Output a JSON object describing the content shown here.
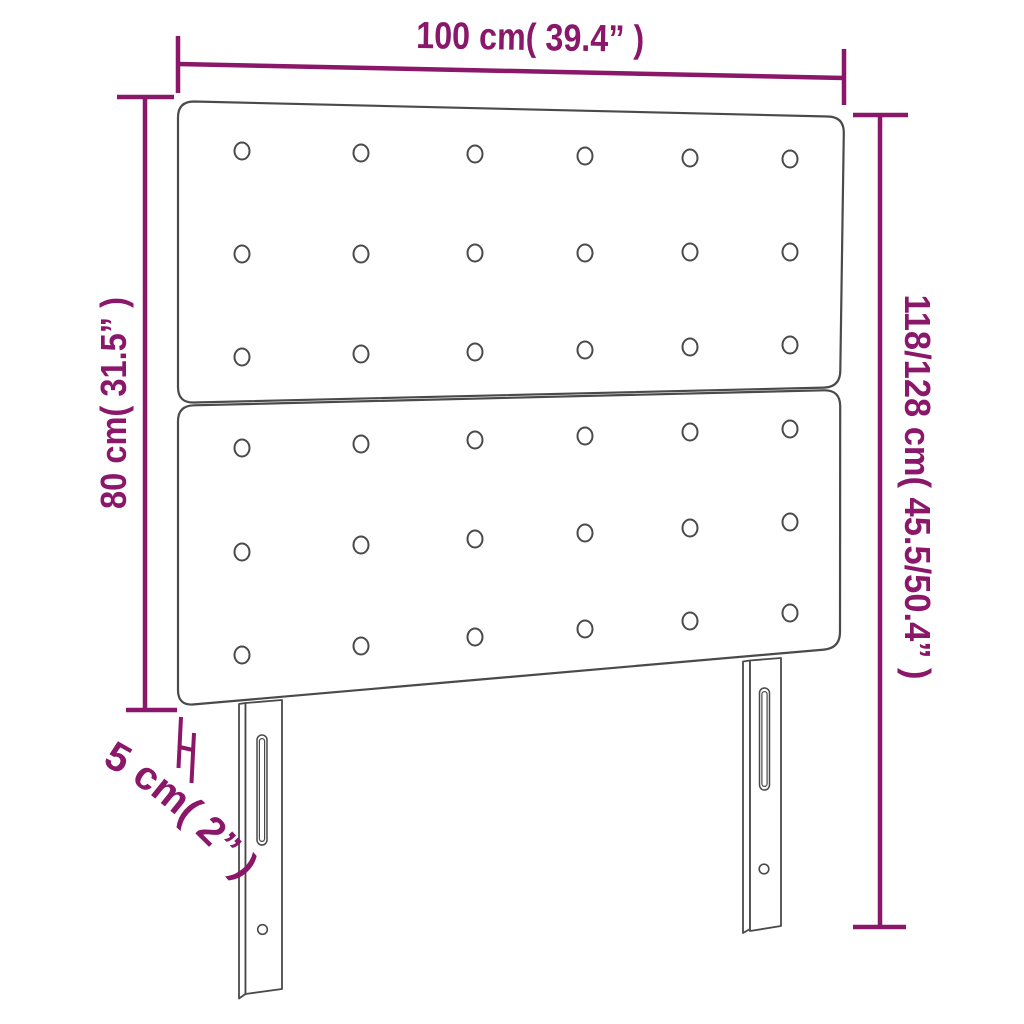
{
  "diagram": {
    "type": "product-dimension-diagram",
    "subject": "upholstered headboard with two panels and two slotted legs",
    "labels": {
      "width": "100 cm( 39.4” )",
      "total_height": "118/128 cm( 45.5/50.4” )",
      "board_height": "80 cm( 31.5” )",
      "leg_depth": "5 cm( 2” )"
    },
    "colors": {
      "dimension_accent": "#8A1769",
      "outline": "#4A4A4A",
      "background": "#FFFFFF"
    },
    "structure": {
      "panels": 2,
      "button_rows_per_panel": 3,
      "button_columns": 6,
      "legs": 2
    }
  }
}
